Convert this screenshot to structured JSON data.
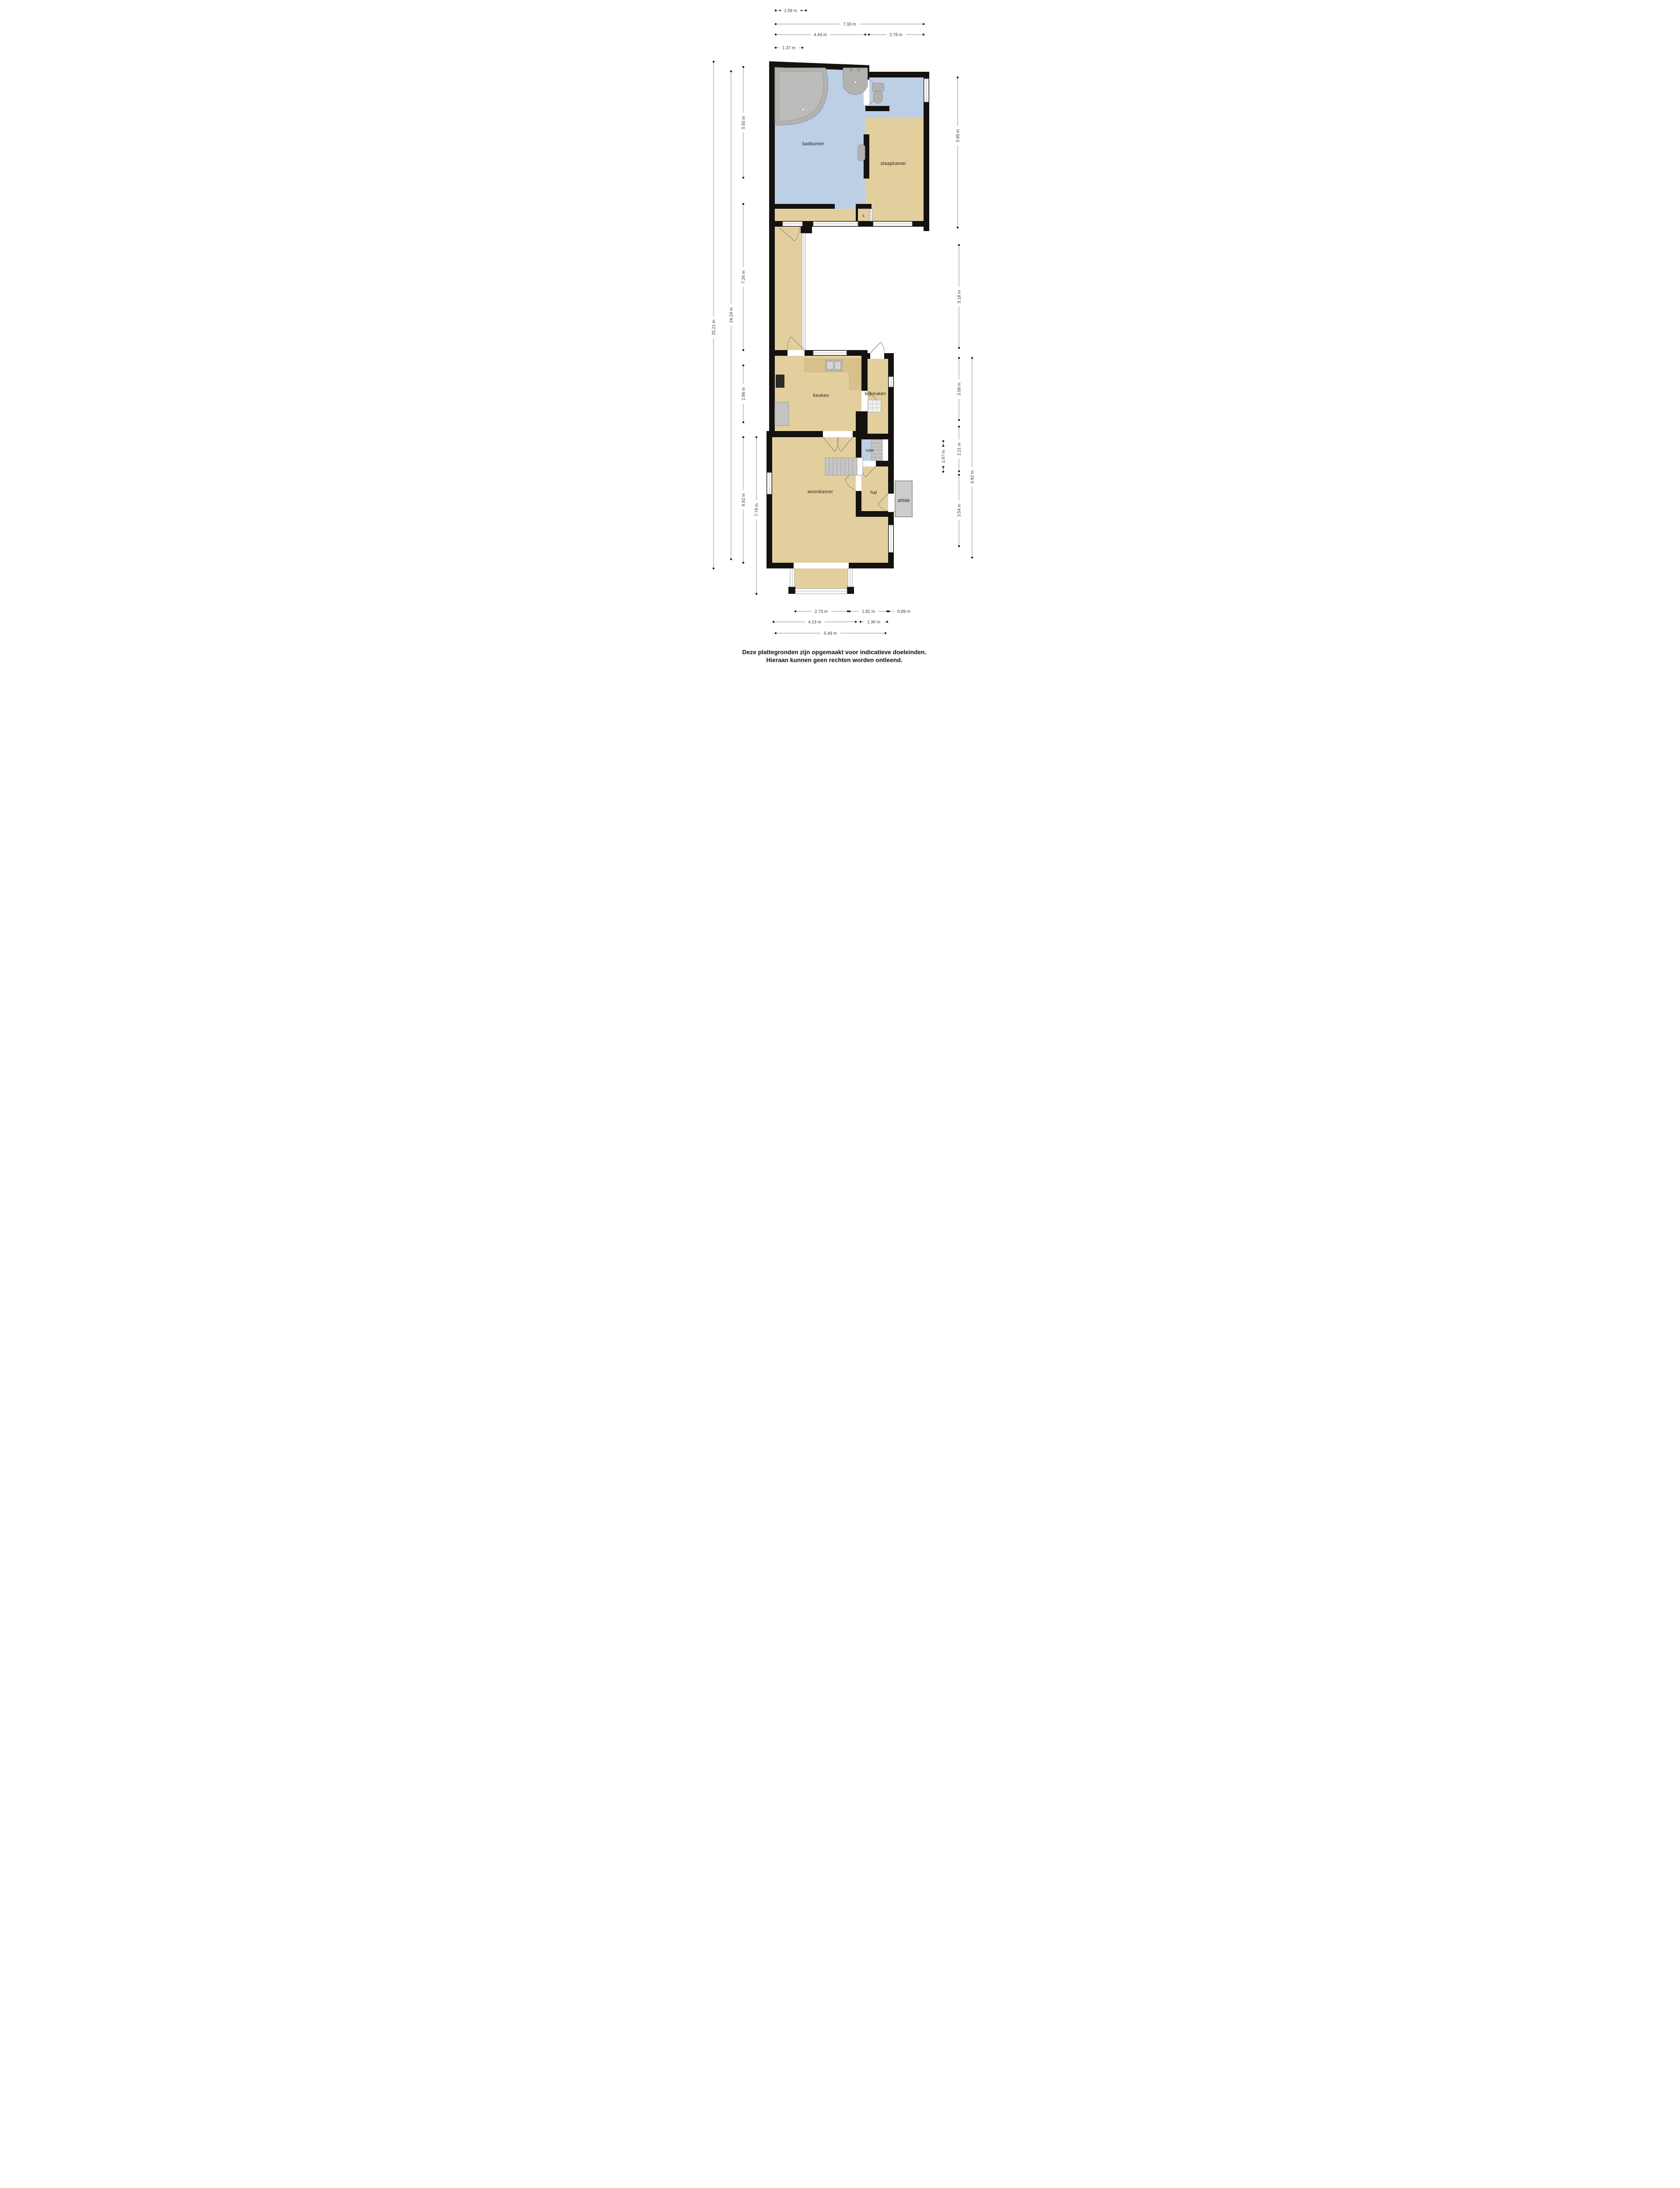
{
  "title": "Plattegrond begane grond",
  "colors": {
    "wall": "#14120e",
    "floor_tan": "#e3cf9e",
    "floor_blue": "#bccfe5",
    "fixture_gray": "#b2b2b0",
    "afdak_gray": "#cdcdcb",
    "dimension_line": "#c9c9c9",
    "dimension_text": "#3a3a3a",
    "background": "#ffffff"
  },
  "rooms": {
    "badkamer": "badkamer",
    "slaapkamer": "slaapkamer",
    "closet": "k",
    "keuken": "keuken",
    "bijkeuken": "bijkeuken",
    "toilet": "toilet",
    "hal": "hal",
    "afdak": "afdak",
    "woonkamer": "woonkamer"
  },
  "dimensions": {
    "top": [
      {
        "label": "1.59 m"
      },
      {
        "label": "7.33 m"
      },
      {
        "label": "4.44 m"
      },
      {
        "label": "2.78 m"
      },
      {
        "label": "1.37 m"
      }
    ],
    "left": [
      {
        "label": "5.50 m"
      },
      {
        "label": "25.21 m"
      },
      {
        "label": "24.24 m"
      },
      {
        "label": "7.26 m"
      },
      {
        "label": "2.94 m"
      },
      {
        "label": "6.82 m"
      },
      {
        "label": "7.79 m"
      }
    ],
    "right": [
      {
        "label": "5.95 m"
      },
      {
        "label": "5.16 m"
      },
      {
        "label": "3.08 m"
      },
      {
        "label": "9.92 m"
      },
      {
        "label": "2.21 m"
      },
      {
        "label": "1.67 m"
      },
      {
        "label": "3.54 m"
      }
    ],
    "bottom": [
      {
        "label": "2.73 m"
      },
      {
        "label": "1.82 m"
      },
      {
        "label": "0.89 m"
      },
      {
        "label": "4.13 m"
      },
      {
        "label": "1.36 m"
      },
      {
        "label": "5.49 m"
      }
    ]
  },
  "disclaimer": {
    "line1": "Deze plattegronden zijn opgemaakt voor indicatieve doeleinden.",
    "line2": "Hieraan kunnen geen rechten worden ontleend."
  }
}
